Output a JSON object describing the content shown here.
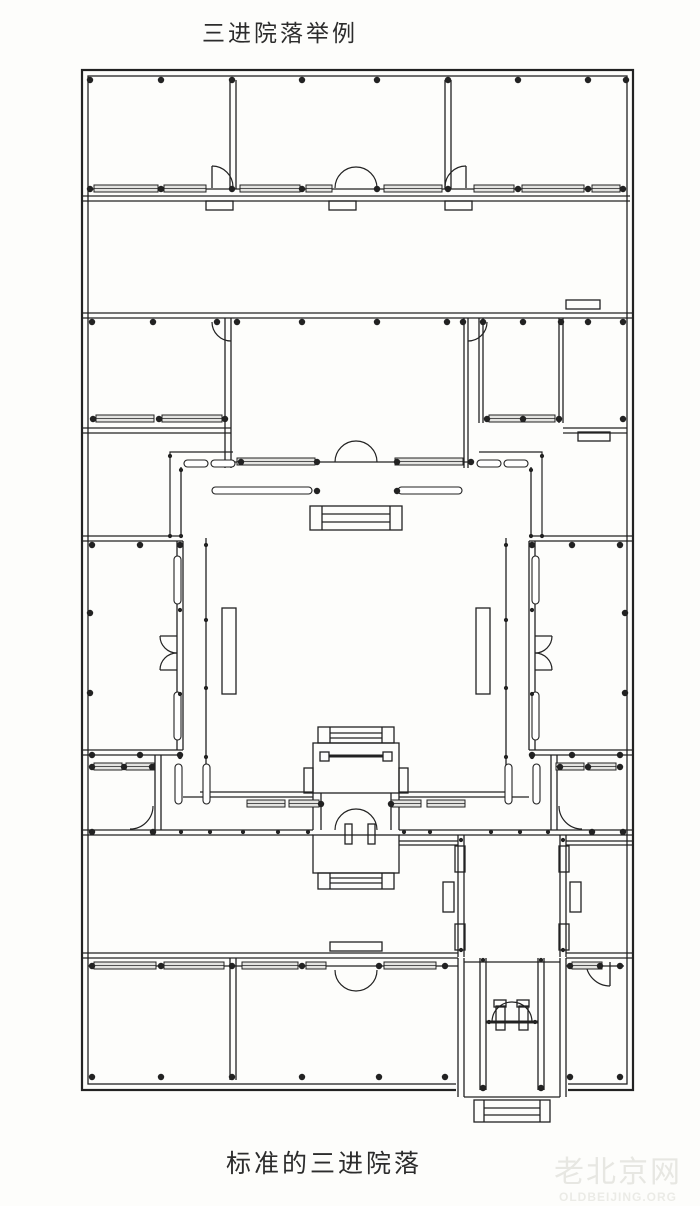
{
  "title": "三进院落举例",
  "caption": "标准的三进院落",
  "watermark": {
    "cn": "老北京网",
    "en": "OLDBEIJING.ORG"
  },
  "colors": {
    "ink": "#222222",
    "paper": "#fdfdfb",
    "window_fill": "#e4e4e1"
  },
  "floor_plan": {
    "canvas": [
      700,
      1206
    ],
    "rects": [
      [
        82,
        70,
        551,
        1020,
        2.2
      ],
      [
        88,
        76,
        539,
        1008,
        1.3
      ],
      [
        206,
        201,
        27,
        9
      ],
      [
        329,
        201,
        27,
        9
      ],
      [
        445,
        201,
        27,
        9
      ],
      [
        566,
        300,
        34,
        9
      ],
      [
        578,
        432,
        32,
        9
      ],
      [
        310,
        506,
        92,
        24
      ],
      [
        222,
        608,
        14,
        86
      ],
      [
        476,
        608,
        14,
        86
      ],
      [
        318,
        727,
        76,
        16
      ],
      [
        313,
        743,
        86,
        50
      ],
      [
        320,
        752,
        9,
        9
      ],
      [
        383,
        752,
        9,
        9
      ],
      [
        304,
        768,
        9,
        25
      ],
      [
        399,
        768,
        9,
        25
      ],
      [
        313,
        835,
        86,
        38
      ],
      [
        318,
        873,
        76,
        16
      ],
      [
        345,
        824,
        7,
        20
      ],
      [
        368,
        824,
        7,
        20
      ],
      [
        455,
        846,
        10,
        26
      ],
      [
        455,
        924,
        10,
        26
      ],
      [
        559,
        846,
        10,
        26
      ],
      [
        559,
        924,
        10,
        26
      ],
      [
        443,
        882,
        11,
        30
      ],
      [
        570,
        882,
        11,
        30
      ],
      [
        330,
        942,
        52,
        9
      ],
      [
        496,
        1006,
        9,
        24
      ],
      [
        519,
        1006,
        9,
        24
      ],
      [
        494,
        1000,
        12,
        7
      ],
      [
        517,
        1000,
        12,
        7
      ],
      [
        474,
        1100,
        76,
        22
      ]
    ],
    "erase_rects": [
      [
        456,
        1076,
        112,
        18
      ]
    ],
    "lines": [
      [
        82,
        196,
        630,
        196
      ],
      [
        82,
        201,
        630,
        201
      ],
      [
        88,
        189,
        624,
        189
      ],
      [
        230,
        80,
        230,
        189
      ],
      [
        236,
        80,
        236,
        189
      ],
      [
        445,
        80,
        445,
        189
      ],
      [
        451,
        80,
        451,
        189
      ],
      [
        212,
        166,
        212,
        188
      ],
      [
        466,
        166,
        466,
        188
      ],
      [
        82,
        313,
        633,
        313
      ],
      [
        82,
        318,
        633,
        318
      ],
      [
        225,
        318,
        225,
        468
      ],
      [
        231,
        318,
        231,
        468
      ],
      [
        464,
        318,
        464,
        468
      ],
      [
        468,
        318,
        468,
        468
      ],
      [
        231,
        462,
        468,
        462
      ],
      [
        479,
        318,
        479,
        423
      ],
      [
        483,
        318,
        483,
        423
      ],
      [
        559,
        318,
        559,
        423
      ],
      [
        563,
        318,
        563,
        423
      ],
      [
        82,
        428,
        231,
        428
      ],
      [
        82,
        433,
        231,
        433
      ],
      [
        563,
        428,
        627,
        428
      ],
      [
        563,
        433,
        627,
        433
      ],
      [
        322,
        506,
        322,
        530
      ],
      [
        390,
        506,
        390,
        530
      ],
      [
        322,
        514,
        390,
        514
      ],
      [
        322,
        522,
        390,
        522
      ],
      [
        181,
        467,
        181,
        538
      ],
      [
        531,
        467,
        531,
        538
      ],
      [
        206,
        538,
        206,
        766
      ],
      [
        506,
        538,
        506,
        766
      ],
      [
        82,
        536,
        183,
        536
      ],
      [
        82,
        541,
        183,
        541
      ],
      [
        82,
        750,
        183,
        750
      ],
      [
        82,
        755,
        183,
        755
      ],
      [
        177,
        541,
        177,
        750
      ],
      [
        183,
        541,
        183,
        750
      ],
      [
        177,
        636,
        160,
        636
      ],
      [
        177,
        670,
        160,
        670
      ],
      [
        529,
        536,
        633,
        536
      ],
      [
        529,
        541,
        633,
        541
      ],
      [
        529,
        750,
        633,
        750
      ],
      [
        529,
        755,
        633,
        755
      ],
      [
        529,
        541,
        529,
        750
      ],
      [
        535,
        541,
        535,
        750
      ],
      [
        535,
        636,
        552,
        636
      ],
      [
        535,
        670,
        552,
        670
      ],
      [
        155,
        755,
        155,
        830
      ],
      [
        161,
        755,
        161,
        830
      ],
      [
        551,
        755,
        551,
        830
      ],
      [
        557,
        755,
        557,
        830
      ],
      [
        200,
        792,
        313,
        792
      ],
      [
        183,
        797,
        313,
        797
      ],
      [
        399,
        792,
        512,
        792
      ],
      [
        399,
        797,
        529,
        797
      ],
      [
        82,
        830,
        313,
        830
      ],
      [
        82,
        835,
        313,
        835
      ],
      [
        399,
        830,
        633,
        830
      ],
      [
        399,
        835,
        633,
        835
      ],
      [
        330,
        727,
        330,
        743
      ],
      [
        382,
        727,
        382,
        743
      ],
      [
        330,
        733,
        382,
        733
      ],
      [
        330,
        738,
        382,
        738
      ],
      [
        313,
        793,
        313,
        830
      ],
      [
        321,
        793,
        321,
        830
      ],
      [
        391,
        793,
        391,
        830
      ],
      [
        399,
        793,
        399,
        830
      ],
      [
        330,
        873,
        330,
        889
      ],
      [
        382,
        873,
        382,
        889
      ],
      [
        330,
        878,
        382,
        878
      ],
      [
        330,
        883,
        382,
        883
      ],
      [
        458,
        835,
        458,
        957
      ],
      [
        464,
        835,
        464,
        957
      ],
      [
        560,
        835,
        560,
        957
      ],
      [
        566,
        835,
        566,
        957
      ],
      [
        399,
        841,
        458,
        841
      ],
      [
        399,
        845,
        458,
        845
      ],
      [
        566,
        841,
        633,
        841
      ],
      [
        566,
        845,
        633,
        845
      ],
      [
        82,
        953,
        458,
        953
      ],
      [
        82,
        958,
        458,
        958
      ],
      [
        566,
        953,
        633,
        953
      ],
      [
        566,
        958,
        633,
        958
      ],
      [
        88,
        966,
        458,
        966
      ],
      [
        566,
        966,
        624,
        966
      ],
      [
        230,
        958,
        230,
        1080
      ],
      [
        236,
        958,
        236,
        1080
      ],
      [
        458,
        958,
        458,
        1097
      ],
      [
        464,
        958,
        464,
        1097
      ],
      [
        560,
        958,
        560,
        1097
      ],
      [
        566,
        958,
        566,
        1097
      ],
      [
        480,
        958,
        480,
        1090
      ],
      [
        486,
        958,
        486,
        1090
      ],
      [
        538,
        958,
        538,
        1090
      ],
      [
        544,
        958,
        544,
        1090
      ],
      [
        464,
        962,
        560,
        962
      ],
      [
        464,
        1097,
        560,
        1097
      ],
      [
        484,
        1100,
        484,
        1122
      ],
      [
        540,
        1100,
        540,
        1122
      ],
      [
        484,
        1108,
        540,
        1108
      ],
      [
        484,
        1115,
        540,
        1115
      ],
      [
        610,
        962,
        610,
        986
      ]
    ],
    "beams": [
      [
        329,
        756,
        383,
        756
      ],
      [
        486,
        1022,
        538,
        1022
      ]
    ],
    "paths": [
      "M212,166 A21,21 0 0 1 233,187",
      "M466,166 A21,21 0 0 0 445,187",
      "M335,188 A21,21 0 0 1 356,167",
      "M377,188 A21,21 0 0 0 356,167",
      "M212,322 A19,19 0 0 0 231,341",
      "M487,322 A19,19 0 0 1 468,341",
      "M335,462 A21,21 0 0 1 356,441",
      "M377,462 A21,21 0 0 0 356,441",
      "M233,452 H170 V538",
      "M479,452 H542 V538",
      "M160,636 A17,17 0 0 0 177,653",
      "M160,670 A17,17 0 0 1 177,653",
      "M552,636 A17,17 0 0 1 535,653",
      "M552,670 A17,17 0 0 0 535,653",
      "M153,806 A23,23 0 0 1 130,829",
      "M559,806 A23,23 0 0 0 582,829",
      "M335,830 A21,21 0 0 1 356,809",
      "M377,830 A21,21 0 0 0 356,809",
      "M335,970 A21,21 0 0 0 356,991",
      "M377,970 A21,21 0 0 1 356,991",
      "M492,1022 A20,20 0 0 1 512,1002",
      "M532,1022 A20,20 0 0 0 512,1002",
      "M586,962 A24,24 0 0 0 610,986"
    ],
    "windows_h": [
      [
        94,
        185,
        64
      ],
      [
        164,
        185,
        42
      ],
      [
        240,
        185,
        60
      ],
      [
        306,
        185,
        26
      ],
      [
        384,
        185,
        58
      ],
      [
        474,
        185,
        40
      ],
      [
        522,
        185,
        62
      ],
      [
        592,
        185,
        28
      ],
      [
        96,
        415,
        58
      ],
      [
        162,
        415,
        60
      ],
      [
        237,
        458,
        78
      ],
      [
        395,
        458,
        68
      ],
      [
        489,
        415,
        66
      ],
      [
        247,
        800,
        38
      ],
      [
        289,
        800,
        30
      ],
      [
        391,
        800,
        30
      ],
      [
        427,
        800,
        38
      ],
      [
        94,
        763,
        28
      ],
      [
        126,
        763,
        28
      ],
      [
        556,
        763,
        28
      ],
      [
        588,
        763,
        28
      ],
      [
        94,
        962,
        62
      ],
      [
        164,
        962,
        60
      ],
      [
        242,
        962,
        56
      ],
      [
        306,
        962,
        20
      ],
      [
        384,
        962,
        52
      ],
      [
        572,
        962,
        30
      ]
    ],
    "capsules_h": [
      [
        184,
        460,
        24
      ],
      [
        211,
        460,
        24
      ],
      [
        477,
        460,
        24
      ],
      [
        504,
        460,
        24
      ],
      [
        212,
        487,
        100
      ],
      [
        398,
        487,
        64
      ]
    ],
    "capsules_v": [
      [
        174,
        556,
        48
      ],
      [
        174,
        692,
        48
      ],
      [
        532,
        556,
        48
      ],
      [
        532,
        692,
        48
      ],
      [
        175,
        764,
        40
      ],
      [
        203,
        764,
        40
      ],
      [
        505,
        764,
        40
      ],
      [
        533,
        764,
        40
      ]
    ],
    "columns": [
      [
        90,
        80
      ],
      [
        161,
        80
      ],
      [
        232,
        80
      ],
      [
        302,
        80
      ],
      [
        377,
        80
      ],
      [
        448,
        80
      ],
      [
        518,
        80
      ],
      [
        588,
        80
      ],
      [
        626,
        80
      ],
      [
        90,
        189
      ],
      [
        161,
        189
      ],
      [
        232,
        189
      ],
      [
        302,
        189
      ],
      [
        377,
        189
      ],
      [
        448,
        189
      ],
      [
        518,
        189
      ],
      [
        588,
        189
      ],
      [
        623,
        189
      ],
      [
        92,
        322
      ],
      [
        153,
        322
      ],
      [
        217,
        322
      ],
      [
        237,
        322
      ],
      [
        302,
        322
      ],
      [
        377,
        322
      ],
      [
        447,
        322
      ],
      [
        463,
        322
      ],
      [
        483,
        322
      ],
      [
        523,
        322
      ],
      [
        561,
        322
      ],
      [
        588,
        322
      ],
      [
        623,
        322
      ],
      [
        93,
        419
      ],
      [
        159,
        419
      ],
      [
        225,
        419
      ],
      [
        487,
        419
      ],
      [
        523,
        419
      ],
      [
        559,
        419
      ],
      [
        623,
        419
      ],
      [
        317,
        462
      ],
      [
        397,
        462
      ],
      [
        317,
        491
      ],
      [
        397,
        491
      ],
      [
        241,
        462
      ],
      [
        471,
        462
      ],
      [
        92,
        545
      ],
      [
        140,
        545
      ],
      [
        180,
        545
      ],
      [
        532,
        545
      ],
      [
        572,
        545
      ],
      [
        620,
        545
      ],
      [
        90,
        613
      ],
      [
        90,
        693
      ],
      [
        625,
        613
      ],
      [
        625,
        693
      ],
      [
        92,
        755
      ],
      [
        140,
        755
      ],
      [
        180,
        755
      ],
      [
        532,
        755
      ],
      [
        572,
        755
      ],
      [
        620,
        755
      ],
      [
        92,
        767
      ],
      [
        124,
        767
      ],
      [
        152,
        767
      ],
      [
        560,
        767
      ],
      [
        588,
        767
      ],
      [
        620,
        767
      ],
      [
        92,
        832
      ],
      [
        153,
        832
      ],
      [
        592,
        832
      ],
      [
        623,
        832
      ],
      [
        321,
        804
      ],
      [
        391,
        804
      ],
      [
        92,
        966
      ],
      [
        161,
        966
      ],
      [
        232,
        966
      ],
      [
        302,
        966
      ],
      [
        379,
        966
      ],
      [
        445,
        966
      ],
      [
        570,
        966
      ],
      [
        600,
        966
      ],
      [
        620,
        966
      ],
      [
        92,
        1077
      ],
      [
        161,
        1077
      ],
      [
        232,
        1077
      ],
      [
        302,
        1077
      ],
      [
        379,
        1077
      ],
      [
        445,
        1077
      ],
      [
        570,
        1077
      ],
      [
        620,
        1077
      ],
      [
        483,
        1088
      ],
      [
        541,
        1088
      ]
    ],
    "small_columns": [
      [
        206,
        545
      ],
      [
        206,
        620
      ],
      [
        206,
        688
      ],
      [
        506,
        545
      ],
      [
        506,
        620
      ],
      [
        506,
        688
      ],
      [
        180,
        757
      ],
      [
        206,
        757
      ],
      [
        532,
        757
      ],
      [
        506,
        757
      ],
      [
        180,
        610
      ],
      [
        180,
        694
      ],
      [
        532,
        610
      ],
      [
        532,
        694
      ],
      [
        170,
        456
      ],
      [
        170,
        536
      ],
      [
        181,
        470
      ],
      [
        181,
        536
      ],
      [
        542,
        456
      ],
      [
        542,
        536
      ],
      [
        531,
        470
      ],
      [
        531,
        536
      ],
      [
        181,
        832
      ],
      [
        210,
        832
      ],
      [
        243,
        832
      ],
      [
        278,
        832
      ],
      [
        308,
        832
      ],
      [
        404,
        832
      ],
      [
        430,
        832
      ],
      [
        491,
        832
      ],
      [
        520,
        832
      ],
      [
        548,
        832
      ],
      [
        461,
        840
      ],
      [
        563,
        840
      ],
      [
        461,
        950
      ],
      [
        563,
        950
      ],
      [
        483,
        960
      ],
      [
        541,
        960
      ],
      [
        489,
        1022
      ],
      [
        535,
        1022
      ]
    ]
  }
}
